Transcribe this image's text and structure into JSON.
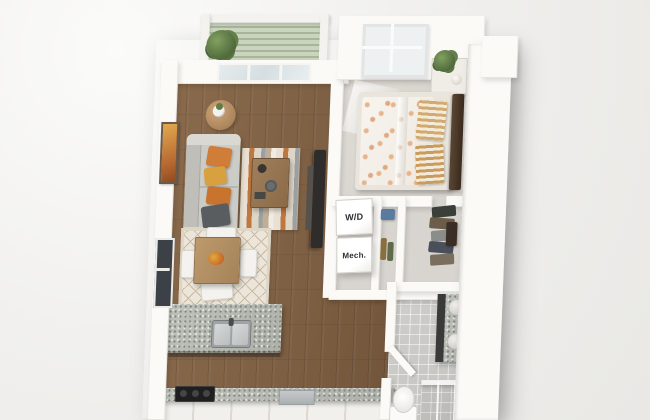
{
  "plan": {
    "type": "3d-apartment-floor-plan",
    "labels": {
      "washer_dryer": "W/D",
      "mechanical": "Mech."
    },
    "colors": {
      "background": "#f0efec",
      "wall_white": "#fbfaf7",
      "wood_floor": "#7d5f43",
      "bedroom_carpet": "#d7d3cd",
      "bathroom_tile": "#c9c8c5",
      "balcony_deck": "#b7c4a8",
      "granite_counter": "#b4b7b0",
      "sofa_grey": "#ccccc7",
      "pillow_orange": "#cf7d38",
      "pillow_mustard": "#d9a03f",
      "pillow_charcoal": "#5a5d60",
      "rug_rust": "#c0763f",
      "rug_cream": "#e8e1d3",
      "rug_grey": "#9ba1a3",
      "dining_wood": "#b08c62",
      "tv_black": "#2e2d2b",
      "headboard_wood": "#463527",
      "plant_green": "#567140",
      "window_dark": "#3c4148",
      "stove_black": "#1f1f1f",
      "towel_teal": "#3e6a6b"
    }
  }
}
